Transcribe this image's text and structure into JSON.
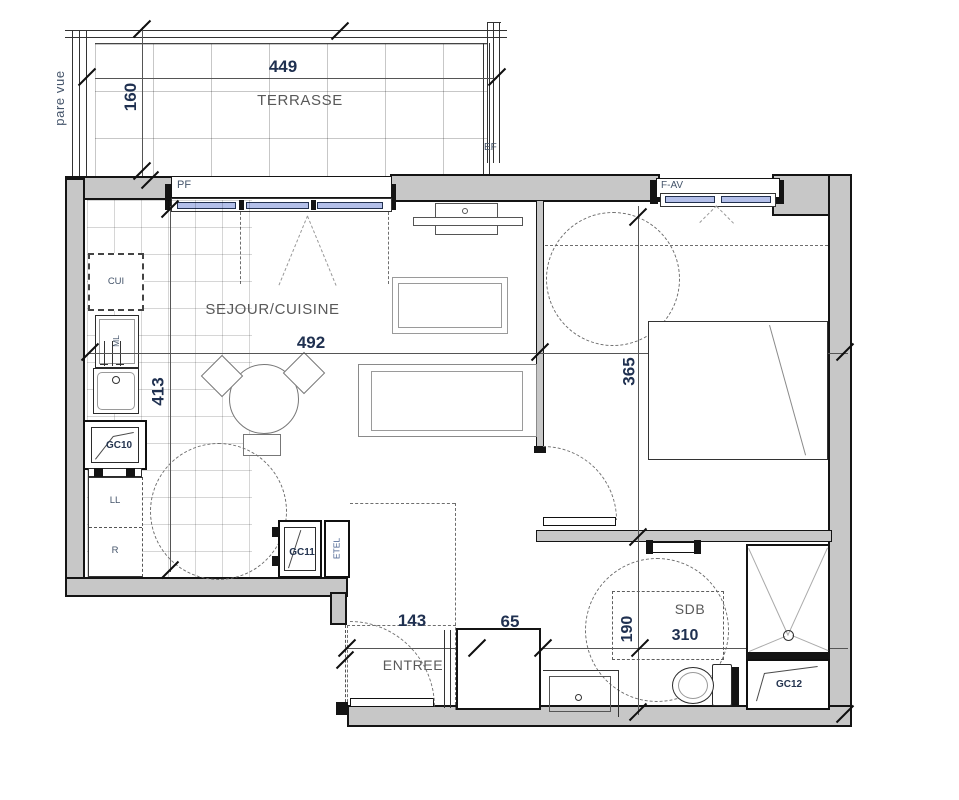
{
  "labels": {
    "terrasse": "TERRASSE",
    "sejour_cuisine": "SEJOUR/CUISINE",
    "chambre": "CHAMBRE",
    "entree": "ENTREE",
    "sdb": "SDB",
    "pare_vue": "pare vue",
    "pf": "PF",
    "ef": "EF",
    "f_av": "F-AV",
    "cui": "CUI",
    "ml": "ML",
    "gc10": "GC10",
    "ll": "LL",
    "r": "R",
    "gc11": "GC11",
    "etel": "ETEL",
    "gc12": "GC12"
  },
  "dimensions_cm": {
    "terrasse_width": "449",
    "terrasse_depth": "160",
    "sejour_width": "492",
    "sejour_depth": "413",
    "chambre_width": "310",
    "chambre_depth": "365",
    "entree_width": "143",
    "placard_width": "65",
    "sdb_depth": "190",
    "sdb_width": "310"
  },
  "colors": {
    "wall_fill": "#c7c7c7",
    "wall_line": "#141414",
    "room_label_text": "#595959",
    "dimension_text": "#1f3050",
    "annotation_text": "#44546a",
    "window_glazing": "#b3bfe9",
    "tile_line": "#c9c9c9",
    "dashed_line": "#6e6e6e"
  }
}
